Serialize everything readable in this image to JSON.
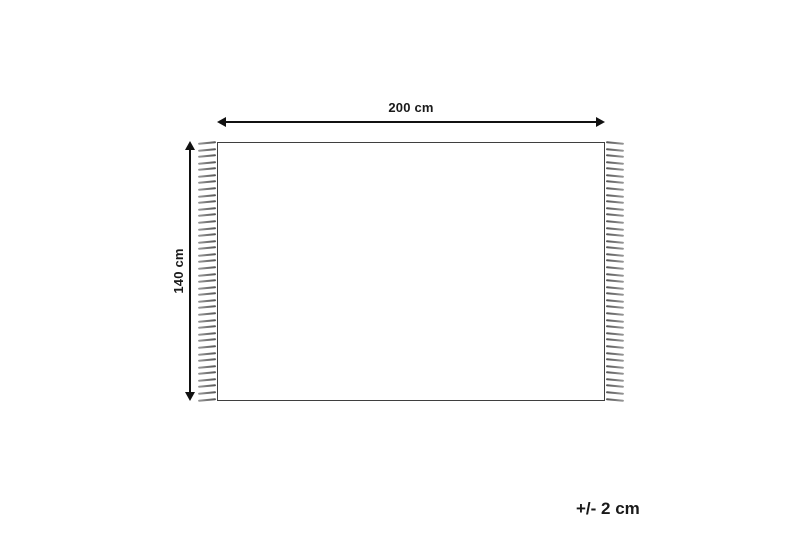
{
  "diagram": {
    "title": "rug-dimension-diagram",
    "width_label": "200 cm",
    "height_label": "140 cm",
    "tolerance_label": "+/- 2 cm"
  },
  "icons": {
    "width_arrow": "double-headed-horizontal-arrow",
    "height_arrow": "double-headed-vertical-arrow",
    "fringe": "rug-fringe-strokes"
  },
  "colors": {
    "background": "#ffffff",
    "line": "#111111",
    "rug_border": "#3f3f3f",
    "fringe_dark": "#555555",
    "fringe_light": "#9a9a9a",
    "text": "#1a1a1a"
  }
}
